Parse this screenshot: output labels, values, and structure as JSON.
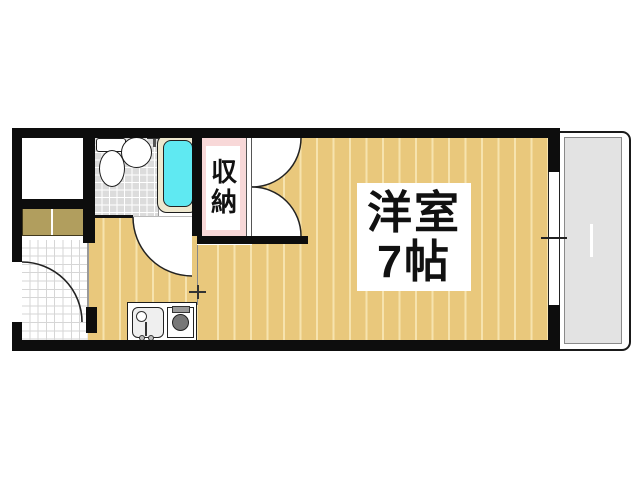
{
  "floor_plan": {
    "main_room": {
      "label_line1": "洋室",
      "label_line2": "7帖"
    },
    "closet": {
      "label": "収納"
    }
  },
  "colors": {
    "wall": "#0d0d0d",
    "flooring": "#e9c87c",
    "flooring_stripe": "#f6e3ae",
    "closet_pink": "#f8d8d8",
    "bath_tile": "#dcdcdc",
    "balcony": "#e3e3e3",
    "cabinet": "#b19e5e",
    "bathtub": "#5fe9f2",
    "tub_rim": "#eee8cf"
  }
}
